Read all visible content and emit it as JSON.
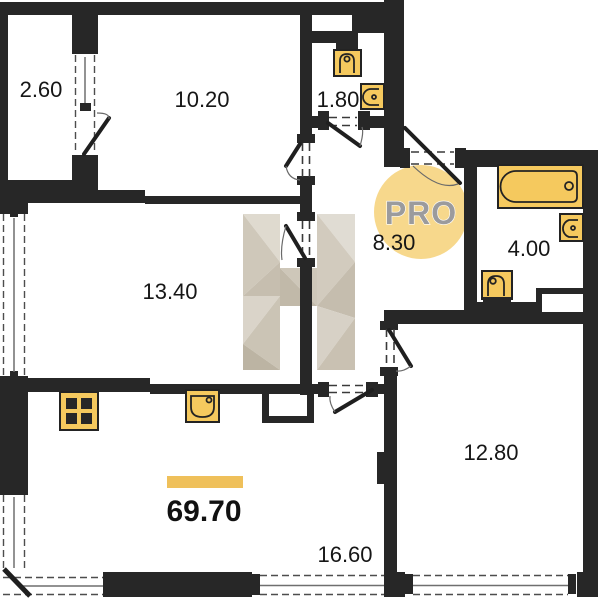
{
  "floor_plan": {
    "badge": {
      "label": "PRO"
    },
    "total": {
      "value": "69.70"
    },
    "watermark_letter": "H",
    "rooms": {
      "balcony": {
        "area": "2.60"
      },
      "bedroom_top": {
        "area": "10.20"
      },
      "wc": {
        "area": "1.80"
      },
      "hallway": {
        "area": "8.30"
      },
      "bathroom": {
        "area": "4.00"
      },
      "room_left": {
        "area": "13.40"
      },
      "room_right": {
        "area": "12.80"
      },
      "living_kitchen": {
        "area": "16.60"
      }
    },
    "icons": [
      "toilet-icon",
      "wc-sink-icon",
      "bathtub-icon",
      "bathroom-sink-icon",
      "bathroom-toilet-icon",
      "stove-icon",
      "kitchen-sink-icon",
      "window-icon",
      "door-swing-icon"
    ],
    "colors": {
      "wall": "#272727",
      "fixture_yellow": "#F5C95E",
      "accent_bar": "#EFC05A",
      "badge_fill": "#F7D88C",
      "badge_text": "#9B9B9D",
      "watermark_light": "#DFDACF",
      "watermark_dark": "#BCB4A3"
    }
  }
}
